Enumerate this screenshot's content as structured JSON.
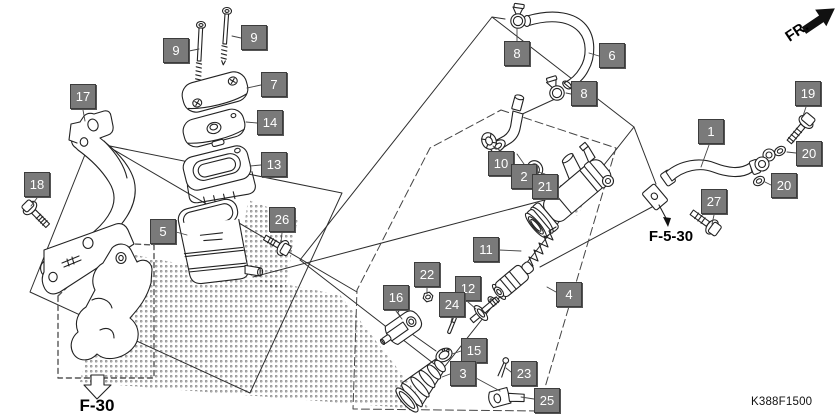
{
  "diagram": {
    "part_code": "K388F1500",
    "front_marker": "FR.",
    "bracket_ref": "F-30",
    "hose_clamp_ref": "F-5-30"
  },
  "callouts": {
    "c1": "1",
    "c2": "2",
    "c3": "3",
    "c4": "4",
    "c5": "5",
    "c6": "6",
    "c7": "7",
    "c8a": "8",
    "c8b": "8",
    "c9a": "9",
    "c9b": "9",
    "c10": "10",
    "c11": "11",
    "c12": "12",
    "c13": "13",
    "c14": "14",
    "c15": "15",
    "c16": "16",
    "c17": "17",
    "c18": "18",
    "c19": "19",
    "c20a": "20",
    "c20b": "20",
    "c21": "21",
    "c22": "22",
    "c23": "23",
    "c24": "24",
    "c25": "25",
    "c26": "26",
    "c27": "27"
  },
  "colors": {
    "callout_bg": "#7a7a7a",
    "callout_border": "#3c3c3c",
    "callout_text": "#ffffff",
    "line": "#222222",
    "accent": "#000000"
  },
  "icons": {
    "front_direction": "fr-arrow",
    "install_direction": "down-block-arrow"
  }
}
